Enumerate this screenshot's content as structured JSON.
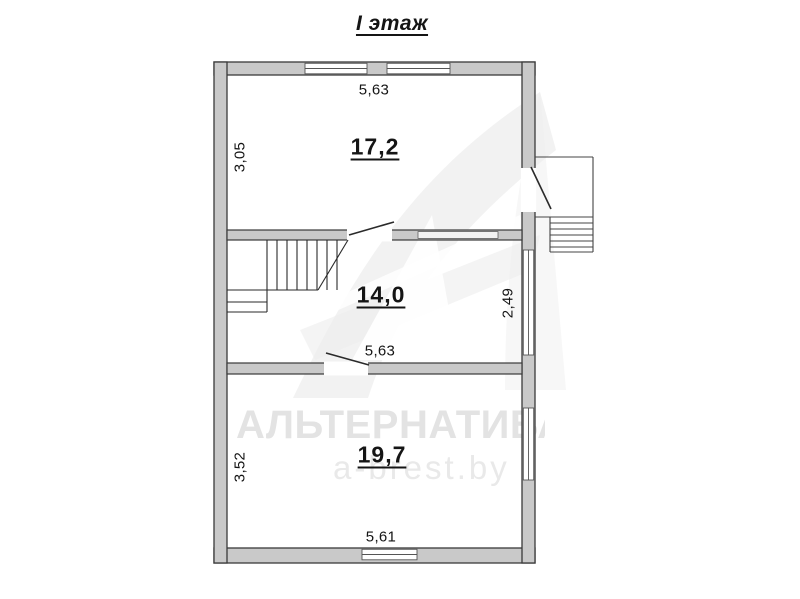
{
  "title": "I этаж",
  "floor_plan": {
    "rooms": [
      {
        "name": "room-top",
        "area_label": "17,2"
      },
      {
        "name": "room-middle",
        "area_label": "14,0"
      },
      {
        "name": "room-bottom",
        "area_label": "19,7"
      }
    ],
    "dimensions": {
      "top_width": "5,63",
      "top_left_height": "3,05",
      "middle_right_height": "2,49",
      "middle_width": "5,63",
      "bottom_left_height": "3,52",
      "bottom_width": "5,61"
    },
    "features": [
      "stairs-with-landing",
      "entrance-porch-with-steps",
      "three-door-openings",
      "five-windows"
    ]
  },
  "watermark": {
    "brand": "АЛЬТЕРНАТИВА",
    "site": "a-brest.by"
  },
  "colors": {
    "wall_fill": "#c9c9c9",
    "wall_outline": "#3a3a3a",
    "line": "#2a2a2a",
    "text": "#151515",
    "watermark_text": "#e3e3e3",
    "logo": "#ededed"
  }
}
